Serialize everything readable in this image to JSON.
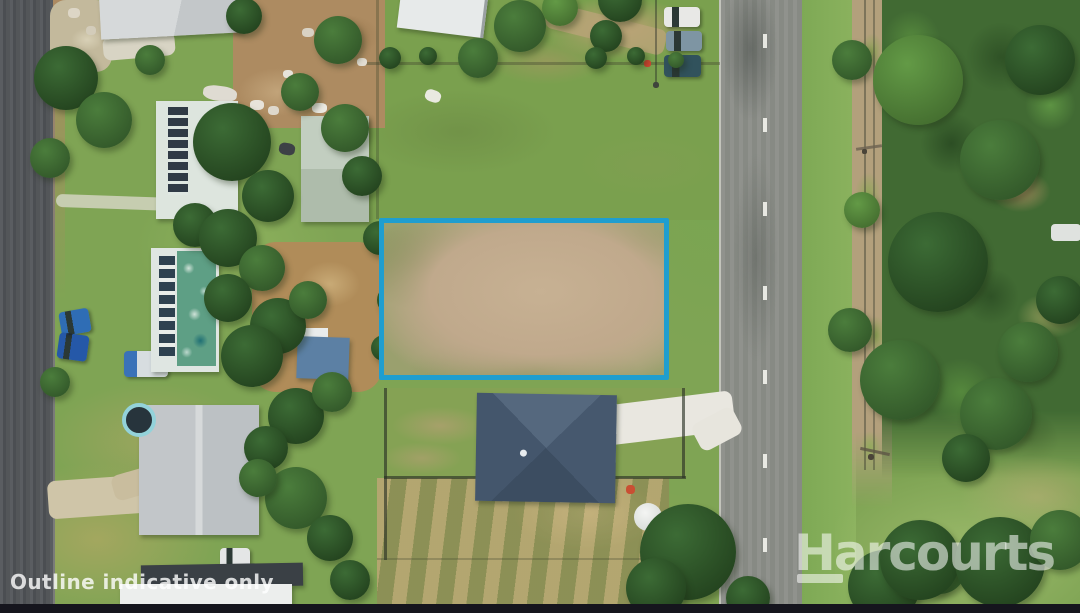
{
  "watermark": {
    "text": "Harcourts"
  },
  "disclaimer": {
    "text": "Outline indicative only"
  },
  "colors": {
    "boundary_outline": "#1f9ecf",
    "watermark_white": "#ffffff",
    "letterbox_bar": "#15151d"
  }
}
